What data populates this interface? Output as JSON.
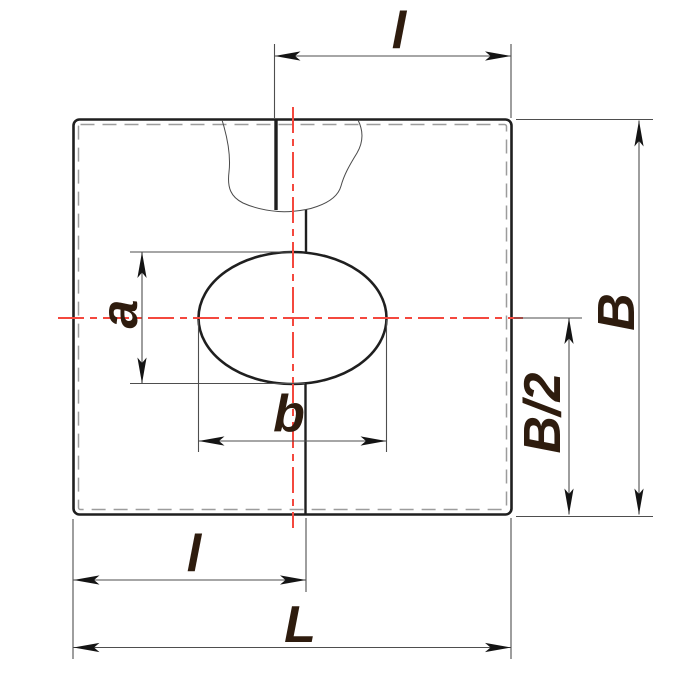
{
  "drawing": {
    "labels": {
      "top_offset": "l",
      "overall_height": "B",
      "half_height": "B/2",
      "hole_height": "a",
      "hole_width": "b",
      "bottom_offset": "l",
      "overall_length": "L"
    },
    "colors": {
      "outline": "#1f1f1f",
      "centerline_red": "#f4483e",
      "hidden_edge_gray": "#9c9c9c",
      "dimension_line": "#4e4e4e",
      "label_text": "#2e1c0e",
      "background": "#ffffff"
    }
  }
}
